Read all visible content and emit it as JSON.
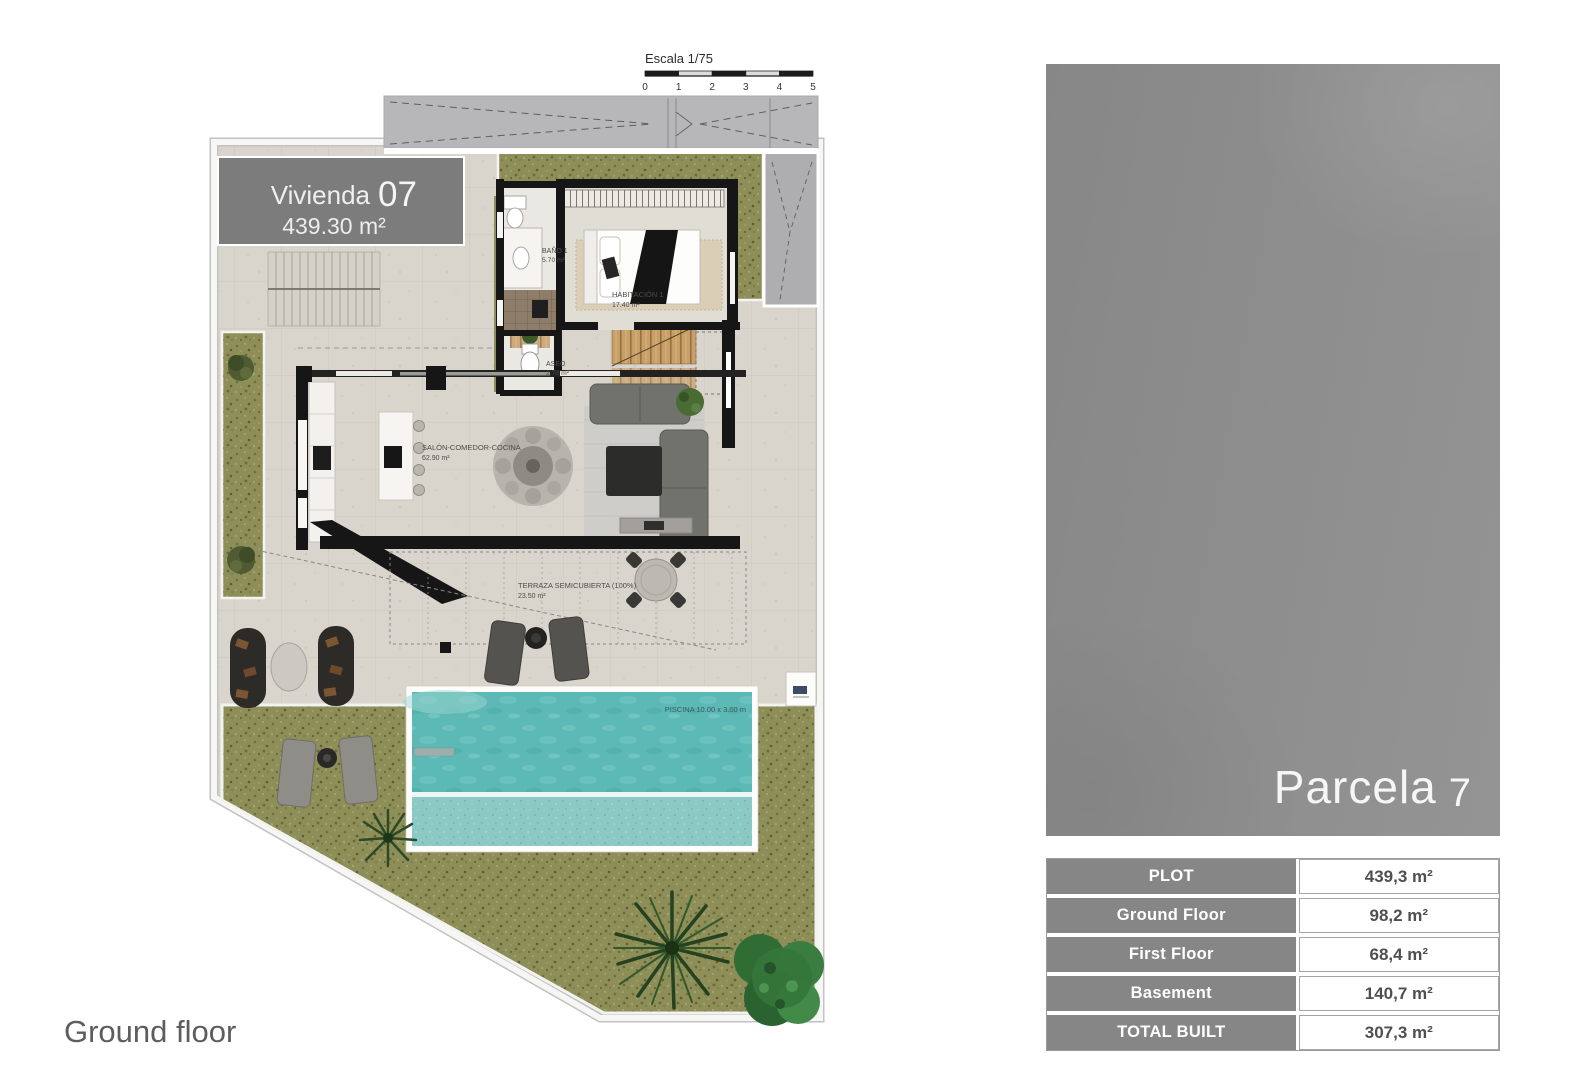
{
  "scale_bar": {
    "label": "Escala 1/75",
    "ticks": [
      "0",
      "1",
      "2",
      "3",
      "4",
      "5"
    ]
  },
  "plan": {
    "unit": {
      "label": "Vivienda",
      "number": "07",
      "area": "439.30 m²"
    },
    "rooms": [
      {
        "name": "BAÑO 1",
        "area": "5.70 m²"
      },
      {
        "name": "HABITACIÓN 1",
        "area": "17.40 m²"
      },
      {
        "name": "ASEO",
        "area": "2.70 m²"
      },
      {
        "name": "SALÓN-COMEDOR-COCINA",
        "area": "62.90 m²"
      },
      {
        "name": "TERRAZA SEMICUBIERTA (100%)",
        "area": "23.50 m²"
      }
    ],
    "pool_label": "PISCINA 10.00 x 3.00 m",
    "floor_label": "Ground floor"
  },
  "parcel": {
    "name": "Parcela",
    "number": "7"
  },
  "areas_table": {
    "rows": [
      {
        "label": "PLOT",
        "value": "439,3 m²"
      },
      {
        "label": "Ground Floor",
        "value": "98,2 m²"
      },
      {
        "label": "First Floor",
        "value": "68,4 m²"
      },
      {
        "label": "Basement",
        "value": "140,7 m²"
      },
      {
        "label": "TOTAL BUILT",
        "value": "307,3 m²"
      }
    ]
  },
  "colors": {
    "panel_gray": "#8d8d8d",
    "table_label_bg": "#868686",
    "grass": "#8e8e58",
    "pool_water": "#5cb9b5",
    "pavement": "#d9d5cc",
    "wall_black": "#161616",
    "unit_box": "#7c7c7c"
  }
}
